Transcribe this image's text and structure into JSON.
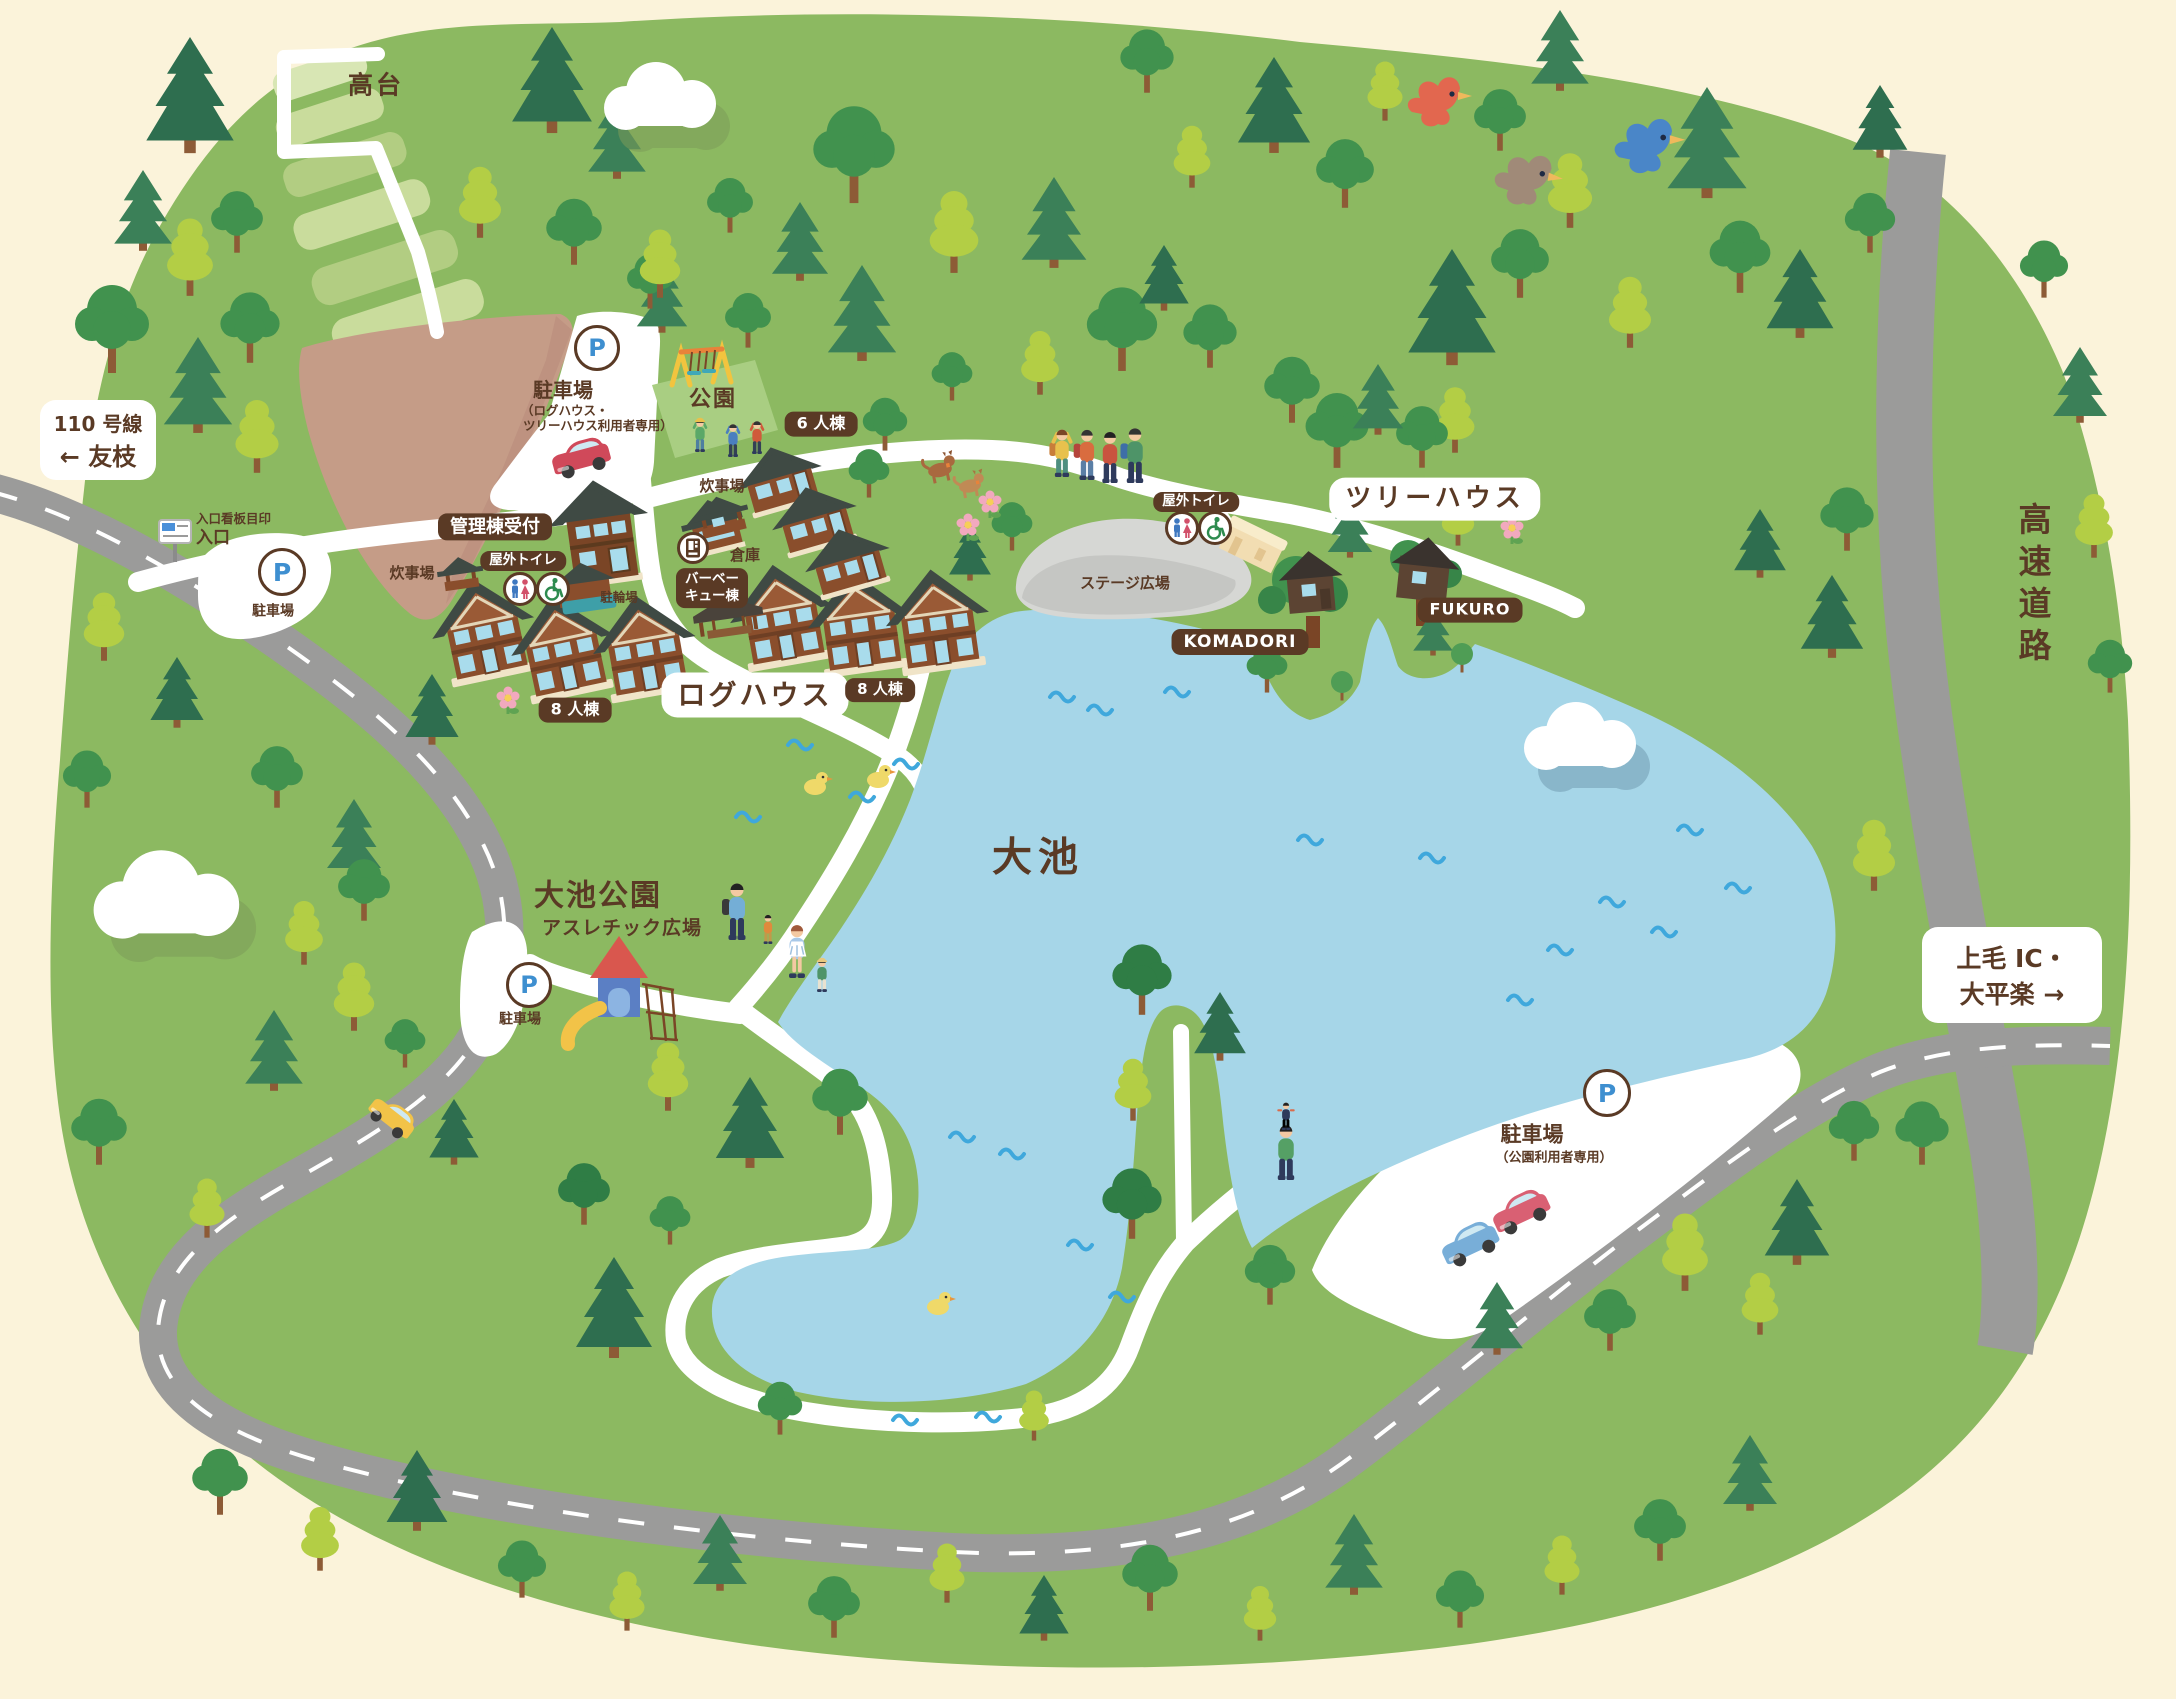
{
  "colors": {
    "cream": "#FBF3DA",
    "park-green": "#8CB961",
    "road-gray": "#9B9B9A",
    "lake-blue": "#A6D6E8",
    "wave-blue": "#3FA8DC",
    "label-brown": "#5A3A25",
    "p-blue": "#3E8FD0",
    "path-white": "#FFFFFF",
    "stage-gray": "#D6D7D4",
    "roof-dark": "#3F4A44",
    "wall-brown": "#8A4E2C",
    "window-blue": "#A9DCEC",
    "light-leaf": "#B3CE45",
    "conifer-dark": "#2E6E4F"
  },
  "labels": {
    "takadai": "高台",
    "route_line1": "110 号線",
    "route_line2": "← 友枝",
    "parking": "駐車場",
    "parking_note1": "（ログハウス・",
    "parking_note2": "ツリーハウス利用者専用）",
    "park": "公園",
    "six_bldg": "6 人棟",
    "cooking": "炊事場",
    "admin": "管理棟受付",
    "toilet": "屋外トイレ",
    "storage": "倉庫",
    "bbq_line1": "バーベー",
    "bbq_line2": "キュー棟",
    "bicycle": "駐輪場",
    "entrance_sign": "入口看板目印",
    "entrance": "入口",
    "eight_bldg": "8 人棟",
    "loghouse": "ログハウス",
    "treehouse": "ツリーハウス",
    "komadori": "KOMADORI",
    "fukuro": "FUKURO",
    "stage": "ステージ広場",
    "pond": "大池",
    "pond_park": "大池公園",
    "athletic": "アスレチック広場",
    "parking_park_note": "（公園利用者専用）",
    "jomo_line1": "上毛 IC・",
    "jomo_line2": "大平楽 →",
    "highway": "高速道路",
    "p": "P"
  },
  "icons": {
    "parking": "P-in-circle",
    "toilet_mf": "male-female-figures",
    "wheelchair": "wheelchair-access",
    "vending": "vending-machine",
    "entrance_board": "signboard",
    "swing": "swing-set",
    "slide": "slide-tower",
    "birds": [
      "red-bird",
      "brown-bird",
      "blue-bird"
    ],
    "ducks": "yellow-duck",
    "cars": [
      "red-car",
      "yellow-car",
      "blue-car"
    ]
  }
}
